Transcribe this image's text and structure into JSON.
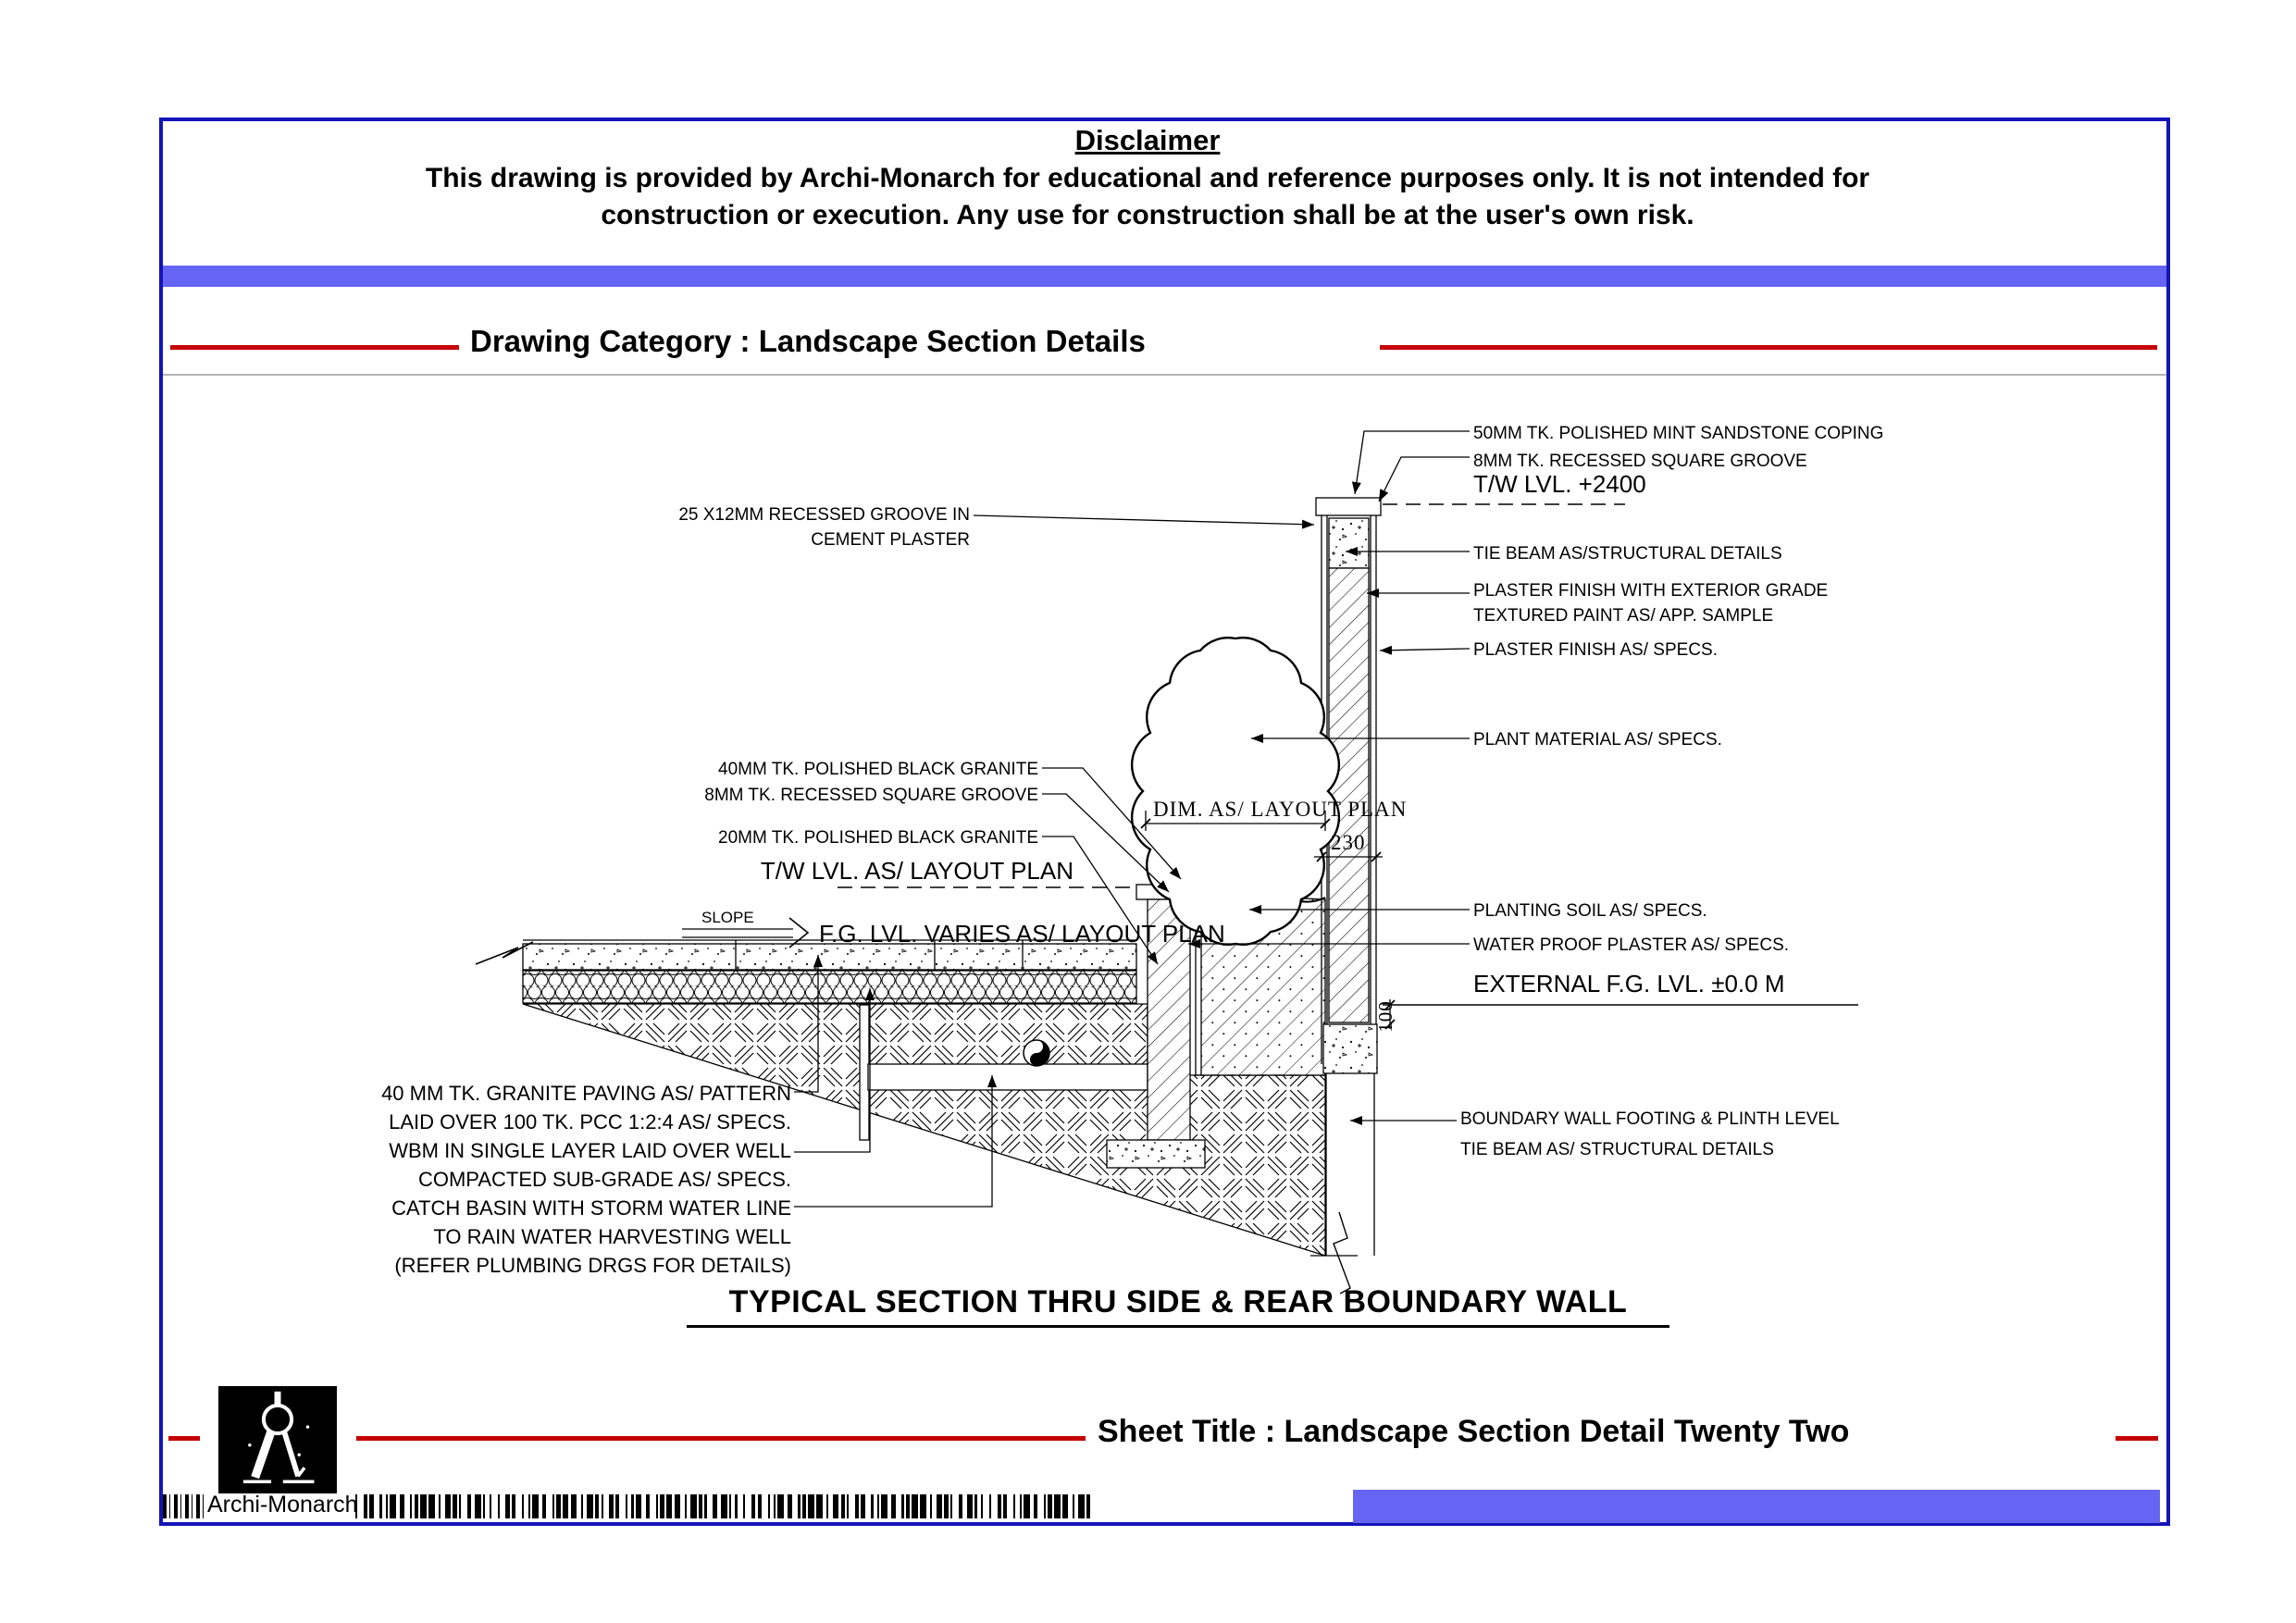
{
  "disclaimer": {
    "title": "Disclaimer",
    "body_line1": "This drawing is provided by Archi-Monarch for educational and reference purposes only. It is not intended for",
    "body_line2": "construction or execution. Any use for construction shall be at the user's own risk."
  },
  "category_heading": "Drawing Category : Landscape Section Details",
  "drawing_title": "TYPICAL SECTION THRU SIDE & REAR BOUNDARY WALL",
  "annotations": {
    "right": {
      "coping": "50MM TK. POLISHED MINT SANDSTONE COPING",
      "groove": "8MM TK. RECESSED SQUARE GROOVE",
      "tw_level": "T/W LVL. +2400",
      "tie_beam": "TIE BEAM AS/STRUCTURAL DETAILS",
      "plaster_textured": "PLASTER FINISH WITH EXTERIOR GRADE\nTEXTURED PAINT AS/ APP. SAMPLE",
      "plaster": "PLASTER FINISH AS/ SPECS.",
      "plant": "PLANT MATERIAL AS/ SPECS.",
      "soil": "PLANTING SOIL AS/ SPECS.",
      "waterproof": "WATER PROOF PLASTER AS/ SPECS.",
      "external_fg": "EXTERNAL F.G. LVL. ±0.0 M",
      "footing": "BOUNDARY WALL FOOTING & PLINTH LEVEL\nTIE BEAM AS/ STRUCTURAL DETAILS"
    },
    "left": {
      "recessed_groove": "25 X12MM RECESSED GROOVE IN\nCEMENT PLASTER",
      "granite40": "40MM TK. POLISHED BLACK GRANITE",
      "groove8": "8MM TK. RECESSED SQUARE GROOVE",
      "granite20": "20MM TK. POLISHED BLACK GRANITE",
      "tw_level": "T/W LVL. AS/ LAYOUT PLAN",
      "slope": "SLOPE",
      "fg_level": "F.G. LVL. VARIES AS/ LAYOUT PLAN",
      "paving": "40 MM TK. GRANITE PAVING AS/ PATTERN\nLAID OVER 100 TK. PCC 1:2:4 AS/ SPECS.",
      "wbm": "WBM IN SINGLE LAYER  LAID OVER WELL\nCOMPACTED SUB-GRADE AS/ SPECS.",
      "catch_basin": "CATCH BASIN WITH STORM WATER LINE\nTO RAIN WATER HARVESTING WELL\n(REFER PLUMBING DRGS FOR DETAILS)"
    },
    "dims": {
      "planter_width": "DIM. AS/ LAYOUT PLAN",
      "wall_thickness": "230",
      "footing_offset": "100"
    }
  },
  "footer": {
    "sheet_title": "Sheet Title : Landscape Section Detail Twenty Two",
    "brand": "Archi-Monarch"
  },
  "colors": {
    "accent_red": "#c40000",
    "band_blue": "#6664f2",
    "frame_navy": "#1414b8"
  }
}
